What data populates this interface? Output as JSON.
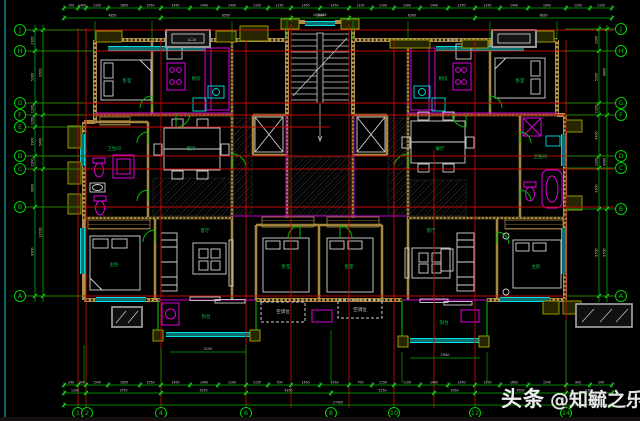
{
  "title": "residential unit floor plan CAD drawing",
  "watermark": {
    "brand": "头条",
    "handle": "@知毓之乐"
  },
  "colors": {
    "background": "#000000",
    "grid_red": "#c40909",
    "dim_green": "#00b400",
    "tick_green": "#3ae23a",
    "bubble_green": "#00d000",
    "wall_tan": "#b3914a",
    "window_cyan": "#00dede",
    "window_teal": "#0a6e6e",
    "fixture_magenta": "#e000e0",
    "furniture_white": "#d4d4d4",
    "label_green": "#00c34a",
    "dim_text_white": "#cfcfcf"
  },
  "axis_bubbles": {
    "left": [
      {
        "label": "J",
        "x": 20,
        "y": 30
      },
      {
        "label": "H",
        "x": 20,
        "y": 51
      },
      {
        "label": "G",
        "x": 20,
        "y": 103
      },
      {
        "label": "F",
        "x": 20,
        "y": 115
      },
      {
        "label": "E",
        "x": 20,
        "y": 127
      },
      {
        "label": "D",
        "x": 20,
        "y": 156
      },
      {
        "label": "C",
        "x": 20,
        "y": 169
      },
      {
        "label": "B",
        "x": 20,
        "y": 207
      },
      {
        "label": "A",
        "x": 20,
        "y": 296
      }
    ],
    "right": [
      {
        "label": "J",
        "x": 621,
        "y": 29
      },
      {
        "label": "H",
        "x": 621,
        "y": 51
      },
      {
        "label": "G",
        "x": 621,
        "y": 103
      },
      {
        "label": "F",
        "x": 621,
        "y": 115
      },
      {
        "label": "D",
        "x": 621,
        "y": 156
      },
      {
        "label": "C",
        "x": 621,
        "y": 168
      },
      {
        "label": "B",
        "x": 621,
        "y": 209
      },
      {
        "label": "A",
        "x": 621,
        "y": 296
      }
    ],
    "bottom": [
      {
        "label": "1",
        "x": 78,
        "y": 413
      },
      {
        "label": "2",
        "x": 87,
        "y": 413
      },
      {
        "label": "4",
        "x": 161,
        "y": 413
      },
      {
        "label": "6",
        "x": 246,
        "y": 413
      },
      {
        "label": "8",
        "x": 331,
        "y": 413
      },
      {
        "label": "10",
        "x": 394,
        "y": 413
      },
      {
        "label": "12",
        "x": 475,
        "y": 413
      },
      {
        "label": "14",
        "x": 566,
        "y": 413
      }
    ]
  },
  "red_grid": {
    "h": [
      {
        "y": 30,
        "x1": 28,
        "x2": 614
      },
      {
        "y": 51,
        "x1": 28,
        "x2": 614
      },
      {
        "y": 103,
        "x1": 28,
        "x2": 614
      },
      {
        "y": 115,
        "x1": 28,
        "x2": 614
      },
      {
        "y": 127,
        "x1": 28,
        "x2": 330
      },
      {
        "y": 156,
        "x1": 28,
        "x2": 614
      },
      {
        "y": 169,
        "x1": 28,
        "x2": 614
      },
      {
        "y": 207,
        "x1": 28,
        "x2": 614
      },
      {
        "y": 296,
        "x1": 28,
        "x2": 614
      }
    ],
    "v": [
      {
        "x": 78,
        "y1": 28,
        "y2": 410
      },
      {
        "x": 86,
        "y1": 28,
        "y2": 410
      },
      {
        "x": 161,
        "y1": 40,
        "y2": 408
      },
      {
        "x": 246,
        "y1": 40,
        "y2": 408
      },
      {
        "x": 291,
        "y1": 24,
        "y2": 408
      },
      {
        "x": 349,
        "y1": 24,
        "y2": 408
      },
      {
        "x": 394,
        "y1": 40,
        "y2": 408
      },
      {
        "x": 434,
        "y1": 150,
        "y2": 408
      },
      {
        "x": 475,
        "y1": 40,
        "y2": 408
      },
      {
        "x": 566,
        "y1": 40,
        "y2": 408
      }
    ]
  },
  "chains": [
    {
      "dir": "h",
      "a1": 64,
      "a2": 612,
      "rows": [
        {
          "line": 8,
          "ticks": [
            64,
            78,
            86,
            108,
            140,
            161,
            190,
            218,
            246,
            268,
            291,
            320,
            349,
            372,
            394,
            420,
            448,
            475,
            500,
            528,
            566,
            590,
            612
          ],
          "labels": [
            "700",
            "1400",
            "1100",
            "1600",
            "1050",
            "1450",
            "1400",
            "1400",
            "1100",
            "1150",
            "1450",
            "1450",
            "1150",
            "1100",
            "1300",
            "1400",
            "1350",
            "1250",
            "1400",
            "1900",
            "1200",
            "1100"
          ]
        },
        {
          "line": 18,
          "ticks": [
            64,
            161,
            291,
            349,
            475,
            612
          ],
          "labels": [
            "4850",
            "6500",
            "2900",
            "6300",
            "6850"
          ]
        }
      ]
    },
    {
      "dir": "h",
      "a1": 64,
      "a2": 612,
      "rows": [
        {
          "line": 385,
          "ticks": [
            64,
            78,
            86,
            108,
            140,
            161,
            190,
            218,
            246,
            268,
            291,
            320,
            349,
            372,
            394,
            420,
            448,
            475,
            500,
            528,
            566,
            590,
            612
          ],
          "labels": [
            "240",
            "900",
            "1540",
            "1600",
            "1050",
            "1450",
            "1400",
            "1100",
            "1150",
            "700",
            "1450",
            "1450",
            "700",
            "1150",
            "1100",
            "1400",
            "1450",
            "1050",
            "1600",
            "1540",
            "900",
            "240"
          ]
        },
        {
          "line": 393,
          "ticks": [
            64,
            86,
            161,
            246,
            331,
            434,
            475,
            566,
            612
          ],
          "labels": [
            "1100",
            "3750",
            "4250",
            "4250",
            "5150",
            "2050",
            "4550",
            "2300"
          ]
        },
        {
          "line": 405,
          "ticks": [
            64,
            612
          ],
          "labels": [
            "27400"
          ]
        }
      ]
    },
    {
      "dir": "v",
      "a1": 25,
      "a2": 302,
      "rows": [
        {
          "line": 35,
          "ticks": [
            30,
            51,
            103,
            115,
            127,
            156,
            169,
            207,
            296
          ],
          "labels": [
            "2100",
            "5200",
            "1200",
            "1200",
            "2900",
            "1300",
            "3800",
            "8900"
          ]
        },
        {
          "line": 43,
          "ticks": [
            30,
            115,
            169,
            296
          ],
          "labels": [
            "8500",
            "5400",
            "12700"
          ]
        }
      ]
    },
    {
      "dir": "v",
      "a1": 25,
      "a2": 302,
      "rows": [
        {
          "line": 599,
          "ticks": [
            29,
            51,
            103,
            115,
            156,
            168,
            209,
            296
          ],
          "labels": [
            "2200",
            "5200",
            "1200",
            "4100",
            "1200",
            "4100",
            "8700"
          ]
        },
        {
          "line": 607,
          "ticks": [
            29,
            115,
            209,
            296
          ],
          "labels": [
            "8600",
            "9400",
            "8700"
          ]
        }
      ]
    }
  ],
  "ext_green": {
    "v": [
      {
        "x": 95,
        "y1": 21,
        "y2": 40
      },
      {
        "x": 152,
        "y1": 21,
        "y2": 40
      },
      {
        "x": 232,
        "y1": 21,
        "y2": 40
      },
      {
        "x": 287,
        "y1": 21,
        "y2": 40
      },
      {
        "x": 353,
        "y1": 21,
        "y2": 40
      },
      {
        "x": 408,
        "y1": 21,
        "y2": 40
      },
      {
        "x": 490,
        "y1": 21,
        "y2": 40
      },
      {
        "x": 557,
        "y1": 21,
        "y2": 40
      },
      {
        "x": 84,
        "y1": 345,
        "y2": 383
      },
      {
        "x": 161,
        "y1": 348,
        "y2": 383
      },
      {
        "x": 246,
        "y1": 345,
        "y2": 383
      },
      {
        "x": 331,
        "y1": 330,
        "y2": 383
      },
      {
        "x": 402,
        "y1": 352,
        "y2": 383
      },
      {
        "x": 487,
        "y1": 352,
        "y2": 383
      },
      {
        "x": 566,
        "y1": 320,
        "y2": 383
      }
    ],
    "h": [
      {
        "y": 30,
        "x1": 25,
        "x2": 84
      },
      {
        "y": 51,
        "x1": 25,
        "x2": 95
      },
      {
        "y": 103,
        "x1": 25,
        "x2": 83
      },
      {
        "y": 115,
        "x1": 25,
        "x2": 83
      },
      {
        "y": 127,
        "x1": 25,
        "x2": 83
      },
      {
        "y": 156,
        "x1": 25,
        "x2": 83
      },
      {
        "y": 169,
        "x1": 25,
        "x2": 83
      },
      {
        "y": 207,
        "x1": 25,
        "x2": 84
      },
      {
        "y": 296,
        "x1": 25,
        "x2": 84
      },
      {
        "y": 29,
        "x1": 565,
        "x2": 616
      },
      {
        "y": 51,
        "x1": 565,
        "x2": 616
      },
      {
        "y": 103,
        "x1": 565,
        "x2": 616
      },
      {
        "y": 115,
        "x1": 565,
        "x2": 616
      },
      {
        "y": 156,
        "x1": 565,
        "x2": 616
      },
      {
        "y": 168,
        "x1": 565,
        "x2": 616
      },
      {
        "y": 209,
        "x1": 565,
        "x2": 616
      },
      {
        "y": 296,
        "x1": 565,
        "x2": 616
      }
    ],
    "extra_dims": [
      {
        "y": 352,
        "x1": 170,
        "x2": 246
      },
      {
        "y": 358,
        "x1": 410,
        "x2": 480
      }
    ]
  },
  "room_labels": [
    {
      "t": "卧室",
      "x": 127,
      "y": 82
    },
    {
      "t": "厨房",
      "x": 196,
      "y": 80
    },
    {
      "t": "餐厅",
      "x": 191,
      "y": 150
    },
    {
      "t": "卫生间",
      "x": 114,
      "y": 150
    },
    {
      "t": "主卧",
      "x": 114,
      "y": 266
    },
    {
      "t": "客厅",
      "x": 205,
      "y": 232
    },
    {
      "t": "阳台",
      "x": 206,
      "y": 318
    },
    {
      "t": "卧室",
      "x": 286,
      "y": 268
    },
    {
      "t": "卧室",
      "x": 349,
      "y": 268
    },
    {
      "t": "客厅",
      "x": 431,
      "y": 232
    },
    {
      "t": "餐厅",
      "x": 440,
      "y": 150
    },
    {
      "t": "厨房",
      "x": 443,
      "y": 80
    },
    {
      "t": "卧室",
      "x": 520,
      "y": 82
    },
    {
      "t": "卫生间",
      "x": 540,
      "y": 158
    },
    {
      "t": "主卧",
      "x": 536,
      "y": 268
    },
    {
      "t": "阳台",
      "x": 444,
      "y": 324
    },
    {
      "t": "空调位",
      "x": 283,
      "y": 313,
      "c": "#cfcfcf"
    },
    {
      "t": "空调位",
      "x": 360,
      "y": 311,
      "c": "#cfcfcf"
    }
  ],
  "window_labels": [
    {
      "t": "LC2428",
      "x": 320,
      "y": 16
    },
    {
      "t": "LC15",
      "x": 192,
      "y": 41
    },
    {
      "t": "LC15",
      "x": 452,
      "y": 41
    },
    {
      "t": "3150",
      "x": 208,
      "y": 350
    },
    {
      "t": "2940",
      "x": 445,
      "y": 356
    }
  ]
}
